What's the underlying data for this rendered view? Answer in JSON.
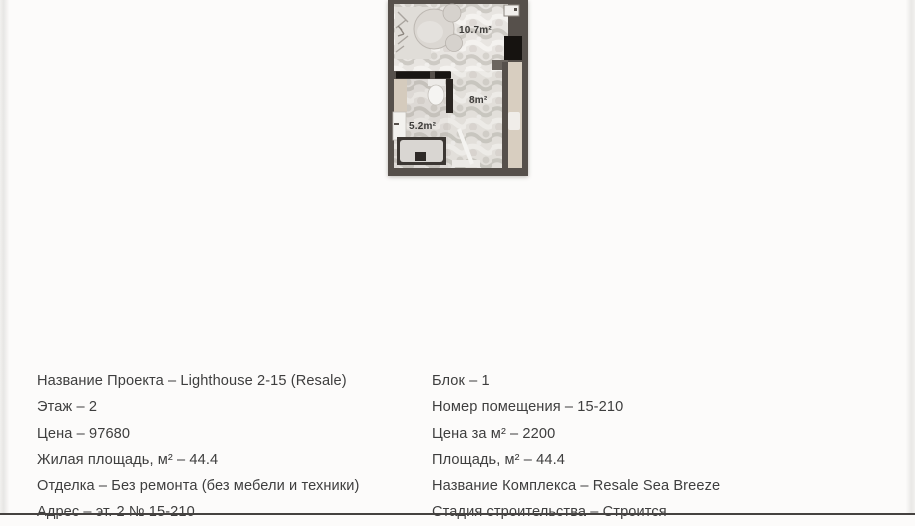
{
  "theme": {
    "bg": "#fcfbfa",
    "text": "#3e3e3e",
    "bottom-bar": "#454240",
    "wall": "#56504b",
    "marble": "#e8e5e1",
    "beige": "#d8cec0"
  },
  "floorplan": {
    "bedroom_area": "10.7m²",
    "hallway_area": "8m²",
    "bathroom_area": "5.2m²"
  },
  "details": {
    "left": [
      "Название Проекта – Lighthouse 2-15 (Resale)",
      "Этаж – 2",
      "Цена – 97680",
      "Жилая площадь, м² – 44.4",
      "Отделка – Без ремонта (без мебели и техники)",
      "Адрес – эт. 2 № 15-210"
    ],
    "right": [
      "Блок – 1",
      "Номер помещения – 15-210",
      "Цена за м² – 2200",
      "Площадь, м² – 44.4",
      "Название Комплекса – Resale Sea Breeze",
      "Стадия строительства – Строится"
    ]
  }
}
